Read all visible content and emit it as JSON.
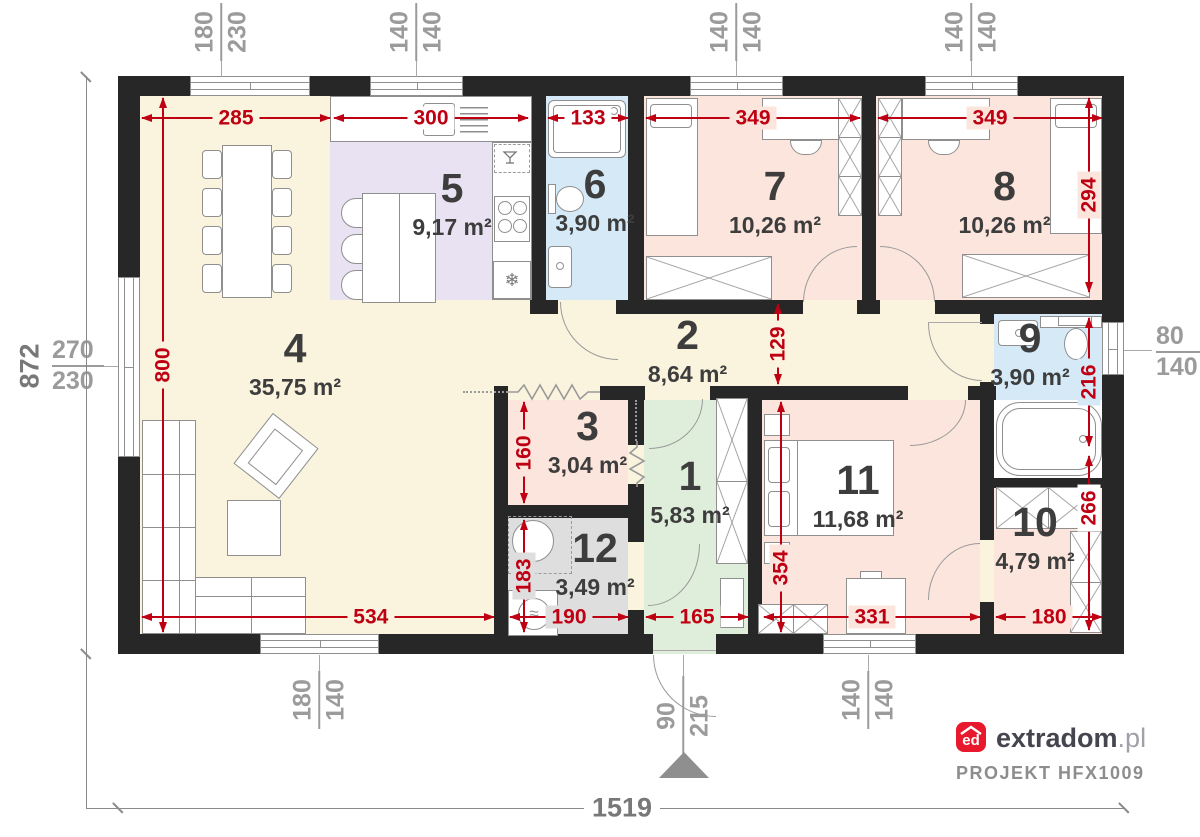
{
  "rooms": {
    "r1": {
      "number": "1",
      "area": "5,83 m²"
    },
    "r2": {
      "number": "2",
      "area": "8,64 m²"
    },
    "r3": {
      "number": "3",
      "area": "3,04 m²"
    },
    "r4": {
      "number": "4",
      "area": "35,75 m²"
    },
    "r5": {
      "number": "5",
      "area": "9,17 m²"
    },
    "r6": {
      "number": "6",
      "area": "3,90 m²"
    },
    "r7": {
      "number": "7",
      "area": "10,26 m²"
    },
    "r8": {
      "number": "8",
      "area": "10,26 m²"
    },
    "r9": {
      "number": "9",
      "area": "3,90 m²"
    },
    "r10": {
      "number": "10",
      "area": "4,79 m²"
    },
    "r11": {
      "number": "11",
      "area": "11,68 m²"
    },
    "r12": {
      "number": "12",
      "area": "3,49 m²"
    }
  },
  "dims": {
    "d285": "285",
    "d300": "300",
    "d133": "133",
    "d349a": "349",
    "d349b": "349",
    "d294": "294",
    "d800": "800",
    "d129": "129",
    "d216": "216",
    "d160": "160",
    "d183": "183",
    "d354": "354",
    "d266": "266",
    "d534": "534",
    "d190": "190",
    "d165": "165",
    "d331": "331",
    "d180": "180"
  },
  "openings": {
    "w180_230": {
      "a": "180",
      "b": "230"
    },
    "w140_140_1": {
      "a": "140",
      "b": "140"
    },
    "w140_140_2": {
      "a": "140",
      "b": "140"
    },
    "w140_140_3": {
      "a": "140",
      "b": "140"
    },
    "w270_230": {
      "a": "270",
      "b": "230"
    },
    "w80_140": {
      "a": "80",
      "b": "140"
    },
    "w180_140": {
      "a": "180",
      "b": "140"
    },
    "door90_215": {
      "a": "90",
      "b": "215"
    },
    "w140_140_4": {
      "a": "140",
      "b": "140"
    }
  },
  "overall": {
    "width": "1519",
    "height": "872"
  },
  "footer": {
    "logo_text": "ed",
    "brand_name": "extradom",
    "brand_tld": ".pl",
    "project": "PROJEKT HFX1009"
  },
  "icons": {
    "freezer": "❄",
    "heater_wave": "≈"
  },
  "colors": {
    "dimension_red": "#bf0013",
    "wall": "#272727",
    "brand_red": "#e8192c",
    "living": "#faf3dd",
    "kitchen": "#e8e2f3",
    "bath": "#d5e9f7",
    "bedroom": "#fbe5dc",
    "entry": "#dfeeda",
    "utility": "#dedede"
  }
}
